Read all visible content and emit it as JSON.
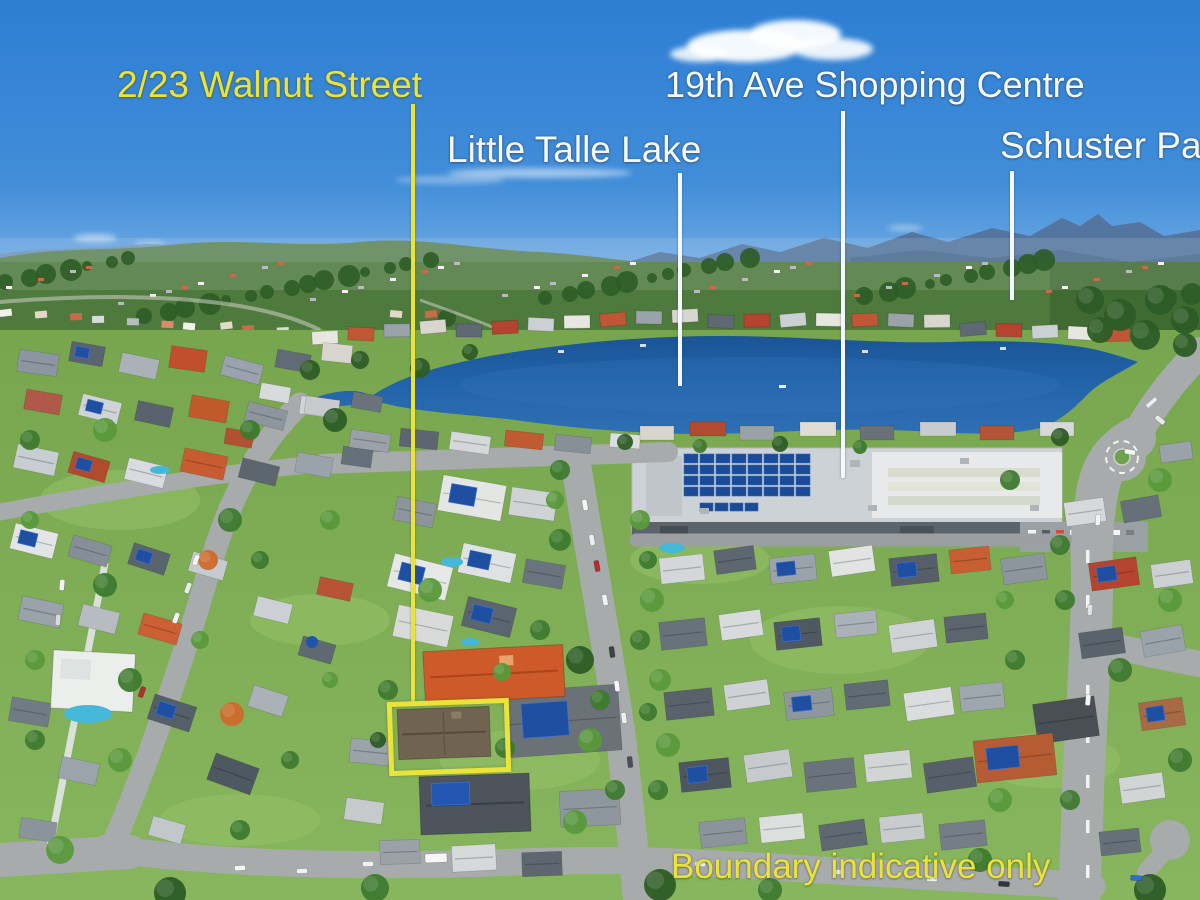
{
  "image_type": "aerial-property-marketing-photo",
  "annotations": {
    "property": {
      "label": "2/23 Walnut Street"
    },
    "lake": {
      "label": "Little Talle Lake"
    },
    "shopping_centre": {
      "label": "19th Ave Shopping Centre"
    },
    "park": {
      "label": "Schuster Park"
    },
    "disclaimer": {
      "label": "Boundary indicative only"
    },
    "colors": {
      "highlight_yellow": "#ece33a",
      "label_white": "#f4f8fb",
      "lake_blue": "#1f5fa4",
      "sky_blue": "#2d7ed3"
    }
  }
}
